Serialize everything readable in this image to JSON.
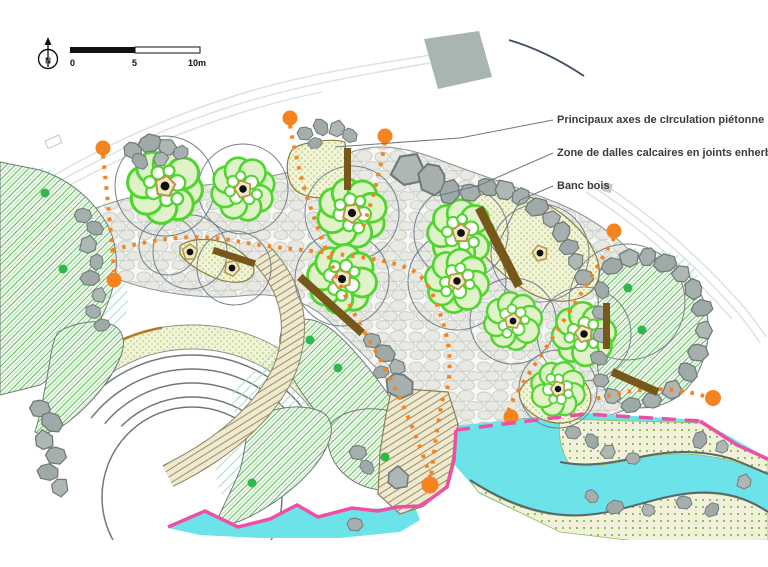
{
  "plan": {
    "annotations": [
      {
        "label": "Principaux axes de cIrculation piétonne"
      },
      {
        "label": "Zone de dalles calcaires en joints enherbés"
      },
      {
        "label": "Banc bois"
      }
    ],
    "scale_bar": {
      "tick_0": "0",
      "tick_5": "5",
      "tick_10": "10m"
    },
    "north": {
      "letter": "N"
    },
    "colors": {
      "path_orange": "#F5831F",
      "boundary_pink": "#EE4FA5",
      "water_cyan": "#6CE3E8",
      "canopy_green": "#50D52F",
      "hatch_green": "#5CBE58",
      "bench_brown": "#77581B",
      "rock_gray": "#A6AFAD"
    }
  }
}
